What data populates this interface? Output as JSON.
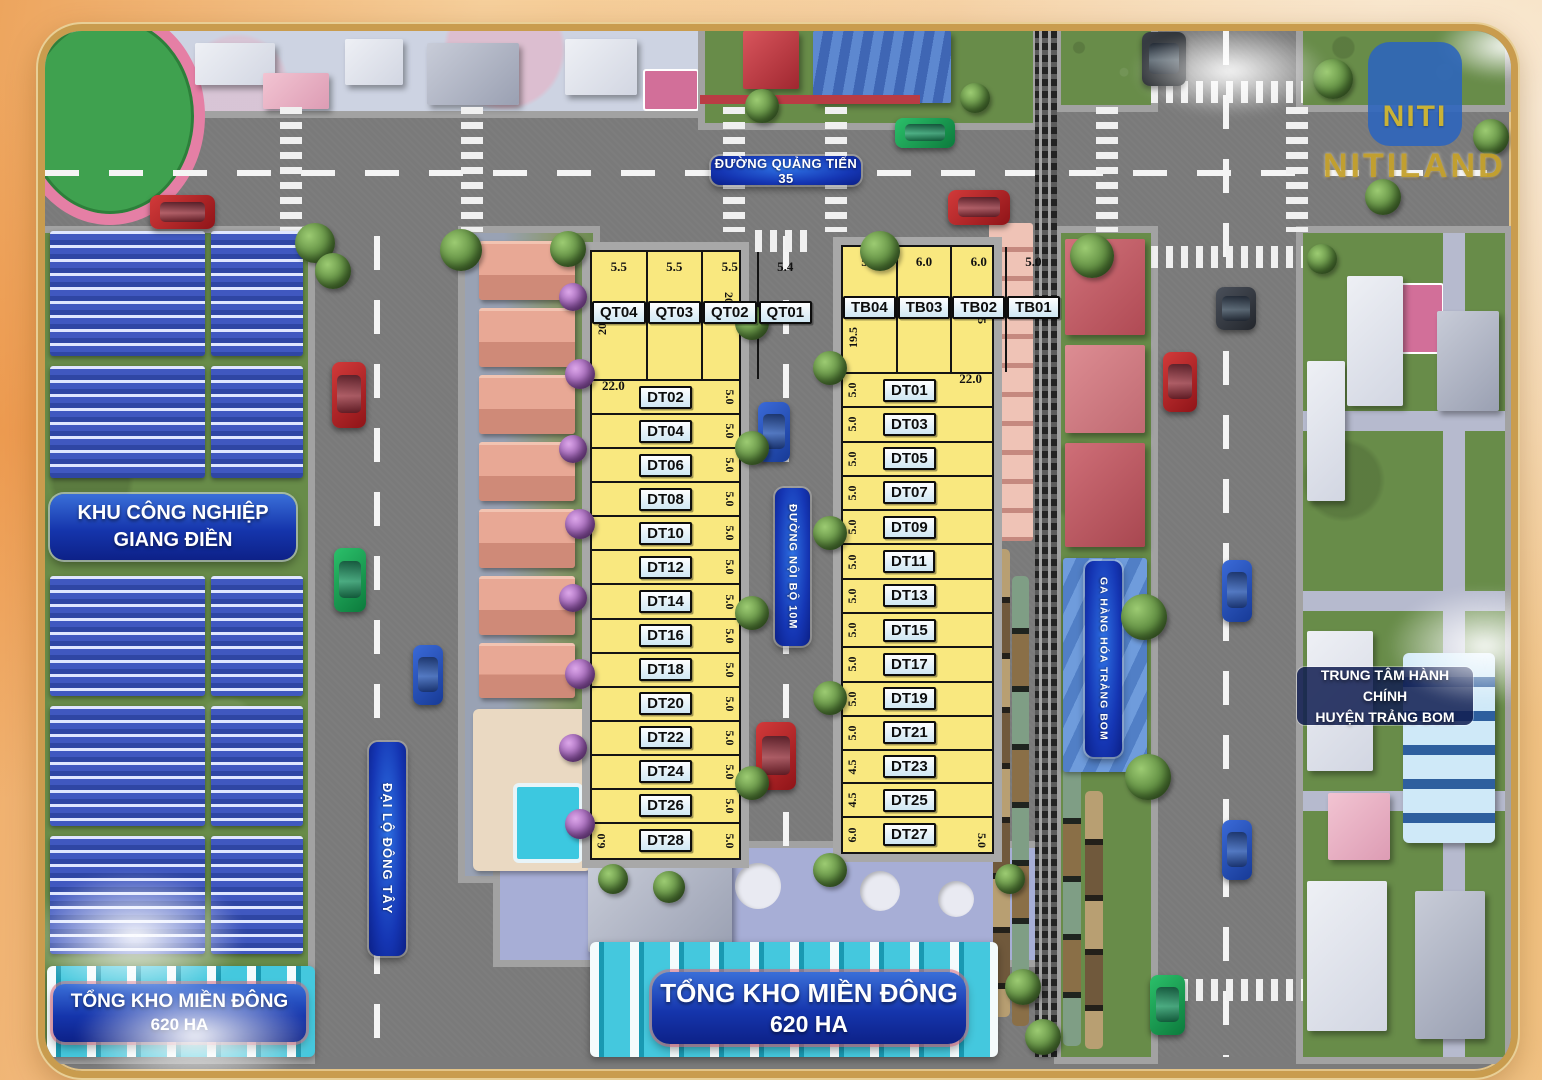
{
  "branding": {
    "logo_mark": "NITI",
    "logo_name": "NITILAND"
  },
  "road_labels": {
    "quang_tien": "ĐƯỜNG QUẢNG TIẾN 35",
    "dai_lo_dong_tay": "ĐẠI LỘ ĐÔNG TÂY",
    "noi_bo": "ĐƯỜNG NỘI BỘ 10M"
  },
  "area_labels": {
    "industrial_line1": "KHU CÔNG NGHIỆP",
    "industrial_line2": "GIANG ĐIỀN",
    "station": "GA HÀNG HÓA TRẢNG BOM",
    "admin_line1": "TRUNG TÂM HÀNH CHÍNH",
    "admin_line2": "HUYỆN TRẢNG BOM",
    "warehouse_line1": "TỔNG KHO MIỀN ĐÔNG",
    "warehouse_line2": "620 HA"
  },
  "left_block": {
    "top_width": "22.0",
    "depth_left": "20.5",
    "depth_right": "20.5",
    "top_plots": [
      {
        "id": "QT04",
        "w": "5.5",
        "grow": 5.5
      },
      {
        "id": "QT03",
        "w": "5.5",
        "grow": 5.5
      },
      {
        "id": "QT02",
        "w": "5.5",
        "grow": 5.5
      },
      {
        "id": "QT01",
        "w": "5.4",
        "grow": 5.4
      }
    ],
    "rows": [
      {
        "id": "DT02",
        "side": "5.0",
        "grow": 5
      },
      {
        "id": "DT04",
        "side": "5.0",
        "grow": 5
      },
      {
        "id": "DT06",
        "side": "5.0",
        "grow": 5
      },
      {
        "id": "DT08",
        "side": "5.0",
        "grow": 5
      },
      {
        "id": "DT10",
        "side": "5.0",
        "grow": 5
      },
      {
        "id": "DT12",
        "side": "5.0",
        "grow": 5
      },
      {
        "id": "DT14",
        "side": "5.0",
        "grow": 5
      },
      {
        "id": "DT16",
        "side": "5.0",
        "grow": 5
      },
      {
        "id": "DT18",
        "side": "5.0",
        "grow": 5
      },
      {
        "id": "DT20",
        "side": "5.0",
        "grow": 5
      },
      {
        "id": "DT22",
        "side": "5.0",
        "grow": 5
      },
      {
        "id": "DT24",
        "side": "5.0",
        "grow": 5
      },
      {
        "id": "DT26",
        "side": "5.0",
        "grow": 5
      },
      {
        "id": "DT28",
        "side": "5.0",
        "extra": "6.0",
        "grow": 6
      }
    ]
  },
  "right_block": {
    "top_width": "22.0",
    "depth_left": "19.5",
    "depth_right": "19.5",
    "top_plots": [
      {
        "id": "TB04",
        "w": "5.0",
        "grow": 5
      },
      {
        "id": "TB03",
        "w": "6.0",
        "grow": 6
      },
      {
        "id": "TB02",
        "w": "6.0",
        "grow": 6
      },
      {
        "id": "TB01",
        "w": "5.0",
        "grow": 5
      }
    ],
    "rows": [
      {
        "id": "DT01",
        "side": "5.0",
        "grow": 5
      },
      {
        "id": "DT03",
        "side": "5.0",
        "grow": 5
      },
      {
        "id": "DT05",
        "side": "5.0",
        "grow": 5
      },
      {
        "id": "DT07",
        "side": "5.0",
        "grow": 5
      },
      {
        "id": "DT09",
        "side": "5.0",
        "grow": 5
      },
      {
        "id": "DT11",
        "side": "5.0",
        "grow": 5
      },
      {
        "id": "DT13",
        "side": "5.0",
        "grow": 5
      },
      {
        "id": "DT15",
        "side": "5.0",
        "grow": 5
      },
      {
        "id": "DT17",
        "side": "5.0",
        "grow": 5
      },
      {
        "id": "DT19",
        "side": "5.0",
        "grow": 5
      },
      {
        "id": "DT21",
        "side": "5.0",
        "grow": 5
      },
      {
        "id": "DT23",
        "side": "4.5",
        "grow": 4.5
      },
      {
        "id": "DT25",
        "side": "4.5",
        "grow": 4.5
      },
      {
        "id": "DT27",
        "side": "6.0",
        "bottom": "5.0",
        "grow": 6
      }
    ]
  },
  "colors": {
    "plot_yellow": "#F9E87F",
    "sign_blue": "#1535B0",
    "road_gray": "#7A7A7A",
    "grass_green": "#688C49",
    "frame_gold": "#C99C4E",
    "cyan_warehouse": "#2FB6CF",
    "logo_gold": "#C5A12C"
  }
}
